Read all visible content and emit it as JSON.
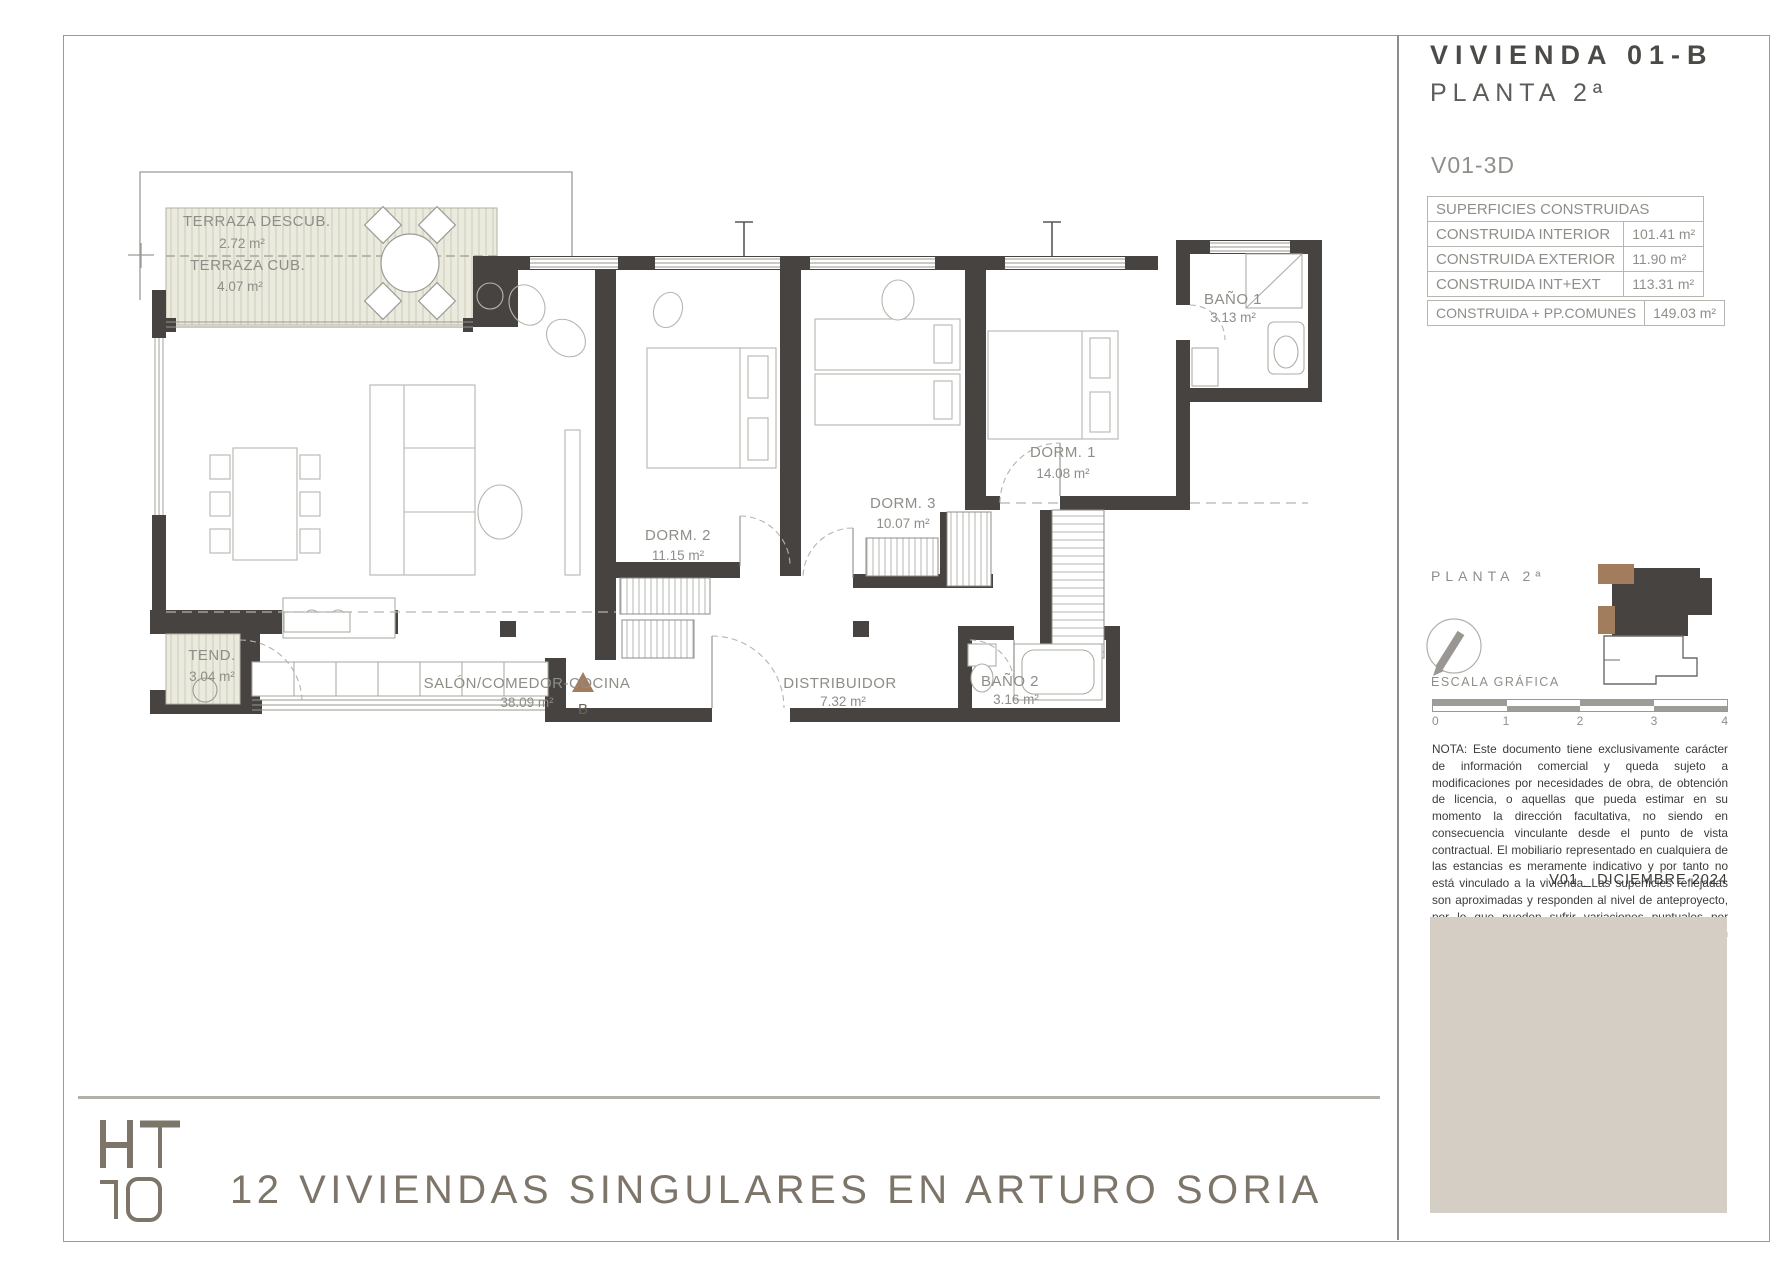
{
  "header": {
    "unit_title": "VIVIENDA 01-B",
    "floor_title": "PLANTA 2ª"
  },
  "surfaces": {
    "model_label": "V01-3D",
    "table_header": "SUPERFICIES CONSTRUIDAS",
    "rows": [
      {
        "label": "CONSTRUIDA INTERIOR",
        "value": "101.41 m²"
      },
      {
        "label": "CONSTRUIDA EXTERIOR",
        "value": "11.90 m²"
      },
      {
        "label": "CONSTRUIDA INT+EXT",
        "value": "113.31 m²"
      }
    ],
    "total": {
      "label": "CONSTRUIDA + PP.COMUNES",
      "value": "149.03 m²"
    }
  },
  "locator": {
    "floor_label": "PLANTA 2ª"
  },
  "scale": {
    "label": "ESCALA GRÁFICA",
    "ticks": [
      "0",
      "1",
      "2",
      "3",
      "4"
    ]
  },
  "note": "NOTA: Este documento tiene exclusivamente carácter de información comercial y queda sujeto a modificaciones por necesidades de obra, de obtención de licencia, o aquellas que pueda estimar en su momento la dirección facultativa, no siendo en consecuencia vinculante desde el punto de vista contractual. El mobiliario representado en cualquiera de las estancias es meramente indicativo y por tanto no está vinculado a la vivienda. Las superficies reflejadas son aproximadas y responden al nivel de anteproyecto, por lo que pueden sufrir variaciones puntuales por necesidades de desarrollo de proyecto o de obtención de licencia.",
  "version_date": "V01 _ DICIEMBRE 2024",
  "footer": {
    "project_title": "12 VIVIENDAS SINGULARES EN ARTURO SORIA",
    "logo_text": "HT10"
  },
  "plan": {
    "rooms": [
      {
        "name": "TERRAZA DESCUB.",
        "area": "2.72 m²"
      },
      {
        "name": "TERRAZA CUB.",
        "area": "4.07 m²"
      },
      {
        "name": "TEND.",
        "area": "3.04 m²"
      },
      {
        "name": "SALÓN/COMEDOR-COCINA",
        "area": "38.09 m²"
      },
      {
        "name": "DORM. 2",
        "area": "11.15 m²"
      },
      {
        "name": "DORM. 3",
        "area": "10.07 m²"
      },
      {
        "name": "DORM. 1",
        "area": "14.08 m²"
      },
      {
        "name": "BAÑO 1",
        "area": "3.13 m²"
      },
      {
        "name": "BAÑO 2",
        "area": "3.16 m²"
      },
      {
        "name": "DISTRIBUIDOR",
        "area": "7.32 m²"
      }
    ],
    "section_marker": "B"
  },
  "colors": {
    "wall": "#474341",
    "accent_brown": "#a17d5e",
    "terrace_fill": "#ebeadf",
    "beige_panel": "#d5cec4",
    "brand": "#7d7569"
  }
}
